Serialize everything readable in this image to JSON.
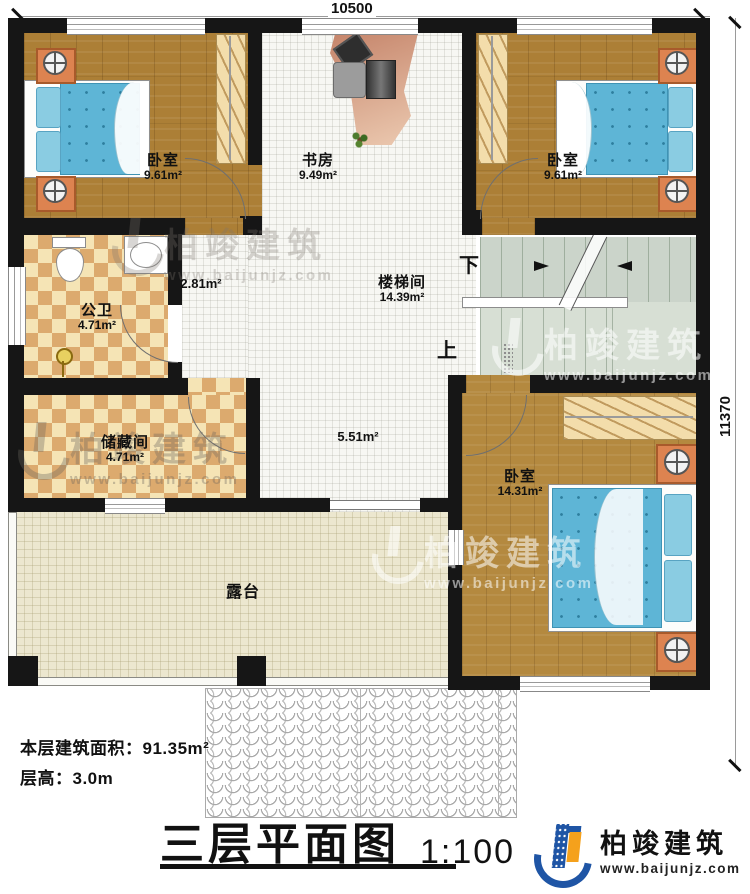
{
  "dimensions": {
    "top": "10500",
    "right": "11370"
  },
  "rooms": [
    {
      "id": "bedroom-top-left",
      "name": "卧室",
      "area": "9.61m²"
    },
    {
      "id": "study",
      "name": "书房",
      "area": "9.49m²"
    },
    {
      "id": "bedroom-top-right",
      "name": "卧室",
      "area": "9.61m²"
    },
    {
      "id": "bathroom",
      "name": "公卫",
      "area": "4.71m²"
    },
    {
      "id": "hallway",
      "name": "",
      "area": "2.81m²"
    },
    {
      "id": "stairwell",
      "name": "楼梯间",
      "area": "14.39m²"
    },
    {
      "id": "storage",
      "name": "储藏间",
      "area": "4.71m²"
    },
    {
      "id": "corridor",
      "name": "",
      "area": "5.51m²"
    },
    {
      "id": "bedroom-bottom",
      "name": "卧室",
      "area": "14.31m²"
    },
    {
      "id": "terrace",
      "name": "露台",
      "area": ""
    }
  ],
  "stairs": {
    "down_label": "下",
    "up_label": "上"
  },
  "footer": {
    "floor_area_label": "本层建筑面积：91.35m²",
    "floor_height_label": "层高：3.0m",
    "title": "三层平面图",
    "scale": "1:100"
  },
  "brand": {
    "name": "柏竣建筑",
    "website": "www.baijunjz.com",
    "blue": "#1f55a5",
    "orange": "#f5a11c"
  },
  "watermark": {
    "name": "柏竣建筑",
    "website": "www.baijunjz.com"
  }
}
